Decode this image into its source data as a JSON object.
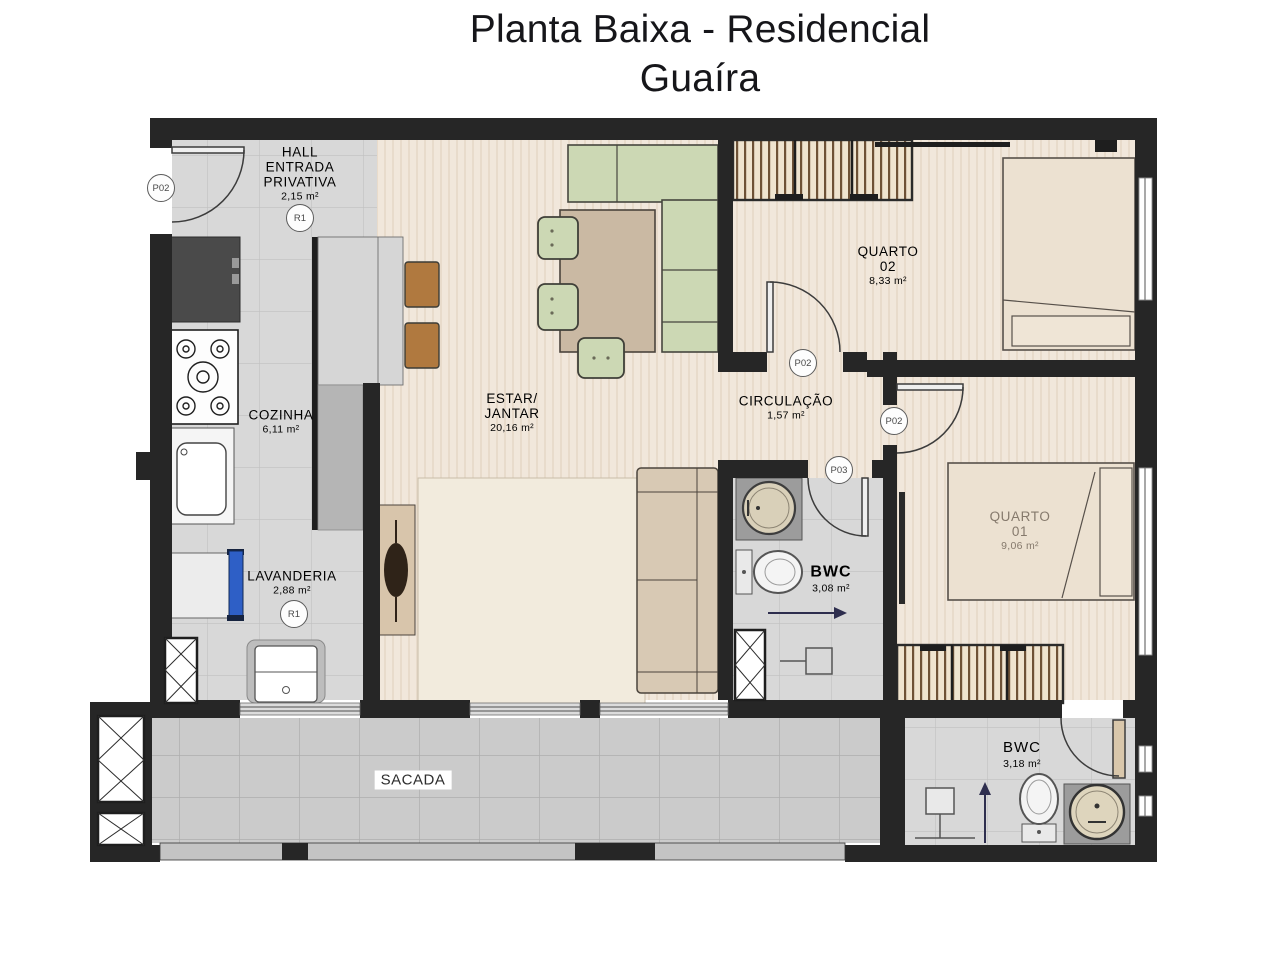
{
  "title": {
    "line1": "Planta Baixa - Residencial",
    "line2": "Guaíra"
  },
  "rooms": {
    "hall": {
      "line1": "HALL",
      "line2": "ENTRADA",
      "line3": "PRIVATIVA",
      "area": "2,15 m²",
      "ref": "R1"
    },
    "cozinha": {
      "name": "COZINHA",
      "area": "6,11 m²"
    },
    "lavanderia": {
      "name": "LAVANDERIA",
      "area": "2,88 m²",
      "ref": "R1"
    },
    "estar_jantar": {
      "line1": "ESTAR/",
      "line2": "JANTAR",
      "area": "20,16 m²"
    },
    "circulacao": {
      "name": "CIRCULAÇÃO",
      "area": "1,57 m²"
    },
    "quarto_02": {
      "line1": "QUARTO",
      "line2": "02",
      "area": "8,33 m²"
    },
    "quarto_01": {
      "line1": "QUARTO",
      "line2": "01",
      "area": "9,06 m²"
    },
    "bwc_social": {
      "name": "BWC",
      "area": "3,08 m²"
    },
    "bwc_servico": {
      "name": "BWC",
      "area": "3,18 m²"
    },
    "sacada": {
      "name": "SACADA"
    }
  },
  "door_tags": {
    "entrada": "P02",
    "quarto_02": "P02",
    "quarto_01": "P02",
    "bwc": "P03"
  },
  "colors": {
    "wall": "#262626",
    "floor_wood": "#f1e7db",
    "floor_tile": "#d8d8d8",
    "floor_balcony": "#cbcbcb",
    "sofa_green": "#ccd8b4",
    "furniture_tan": "#c9b7a0",
    "stool_brown": "#b0793f",
    "laundry_blue": "#2e5fc6",
    "arrow_navy": "#2e2e4e",
    "label_text": "#4f4f4f"
  }
}
